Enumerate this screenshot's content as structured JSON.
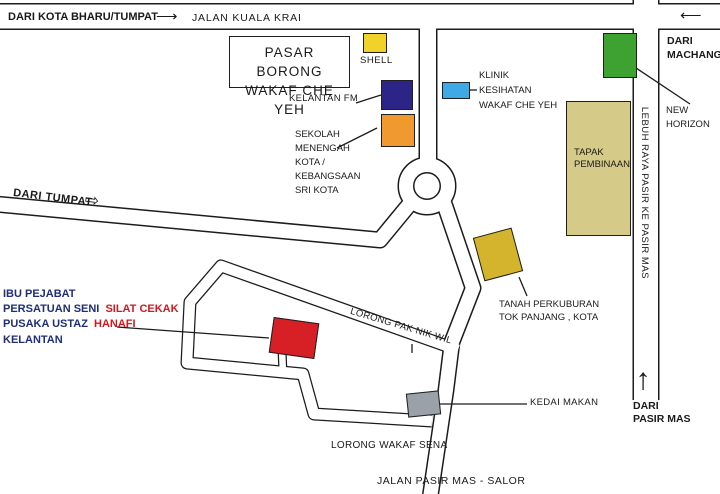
{
  "colors": {
    "shell_box": "#f0d22b",
    "kelantan_fm_box": "#2c2486",
    "sekolah_box": "#f0992e",
    "klinik_box": "#3fa9e8",
    "new_horizon_box": "#3da232",
    "tapak_box": "#d5ca88",
    "tanah_box": "#d3b42c",
    "hq_box": "#d71f26",
    "kedai_box": "#9ba1a9",
    "text_navy": "#1f2d7a",
    "text_red": "#d01820"
  },
  "top_road": {
    "from_label": "DARI KOTA BHARU/TUMPAT",
    "arrow_right": "⟶",
    "name": "JALAN KUALA KRAI"
  },
  "landmarks": {
    "pasar_borong": {
      "line1": "PASAR BORONG",
      "line2": "WAKAF CHE YEH"
    },
    "shell": {
      "label": "SHELL"
    },
    "kelantan_fm": {
      "label": "KELANTAN FM"
    },
    "sekolah": {
      "line1": "SEKOLAH",
      "line2": "MENENGAH",
      "line3": "KOTA /",
      "line4": "KEBANGSAAN",
      "line5": "SRI KOTA"
    },
    "klinik": {
      "line1": "KLINIK",
      "line2": "KESIHATAN",
      "line3": "WAKAF CHE YEH"
    },
    "new_horizon": {
      "line1": "NEW",
      "line2": "HORIZON"
    },
    "tapak": {
      "line1": "TAPAK",
      "line2": "PEMBINAAN"
    },
    "tanah": {
      "line1": "TANAH PERKUBURAN",
      "line2": "TOK PANJANG , KOTA"
    },
    "kedai": {
      "label": "KEDAI MAKAN"
    }
  },
  "hq": {
    "line1": "IBU PEJABAT",
    "line2_a": "PERSATUAN SENI",
    "line2_b": "SILAT CEKAK",
    "line3_a": "PUSAKA USTAZ",
    "line3_b": "HANAFI",
    "line4": "KELANTAN"
  },
  "directions": {
    "dari_tumpat": {
      "label": "DARI TUMPAT",
      "arrow": "⇨"
    },
    "dari_machang": {
      "line1": "DARI",
      "line2": "MACHANG",
      "arrow": "⟵"
    },
    "dari_pasir_mas": {
      "line1": "DARI",
      "line2": "PASIR MAS",
      "arrow": "↑"
    }
  },
  "roads": {
    "lebuh_raya": "LEBUH RAYA PASIR KE PASIR MAS",
    "lorong_pak_nik_wil": "LORONG PAK NIK WIL",
    "lorong_wakaf_sena": "LORONG WAKAF SENA",
    "jalan_pasir_mas_salor": "JALAN PASIR MAS - SALOR"
  }
}
